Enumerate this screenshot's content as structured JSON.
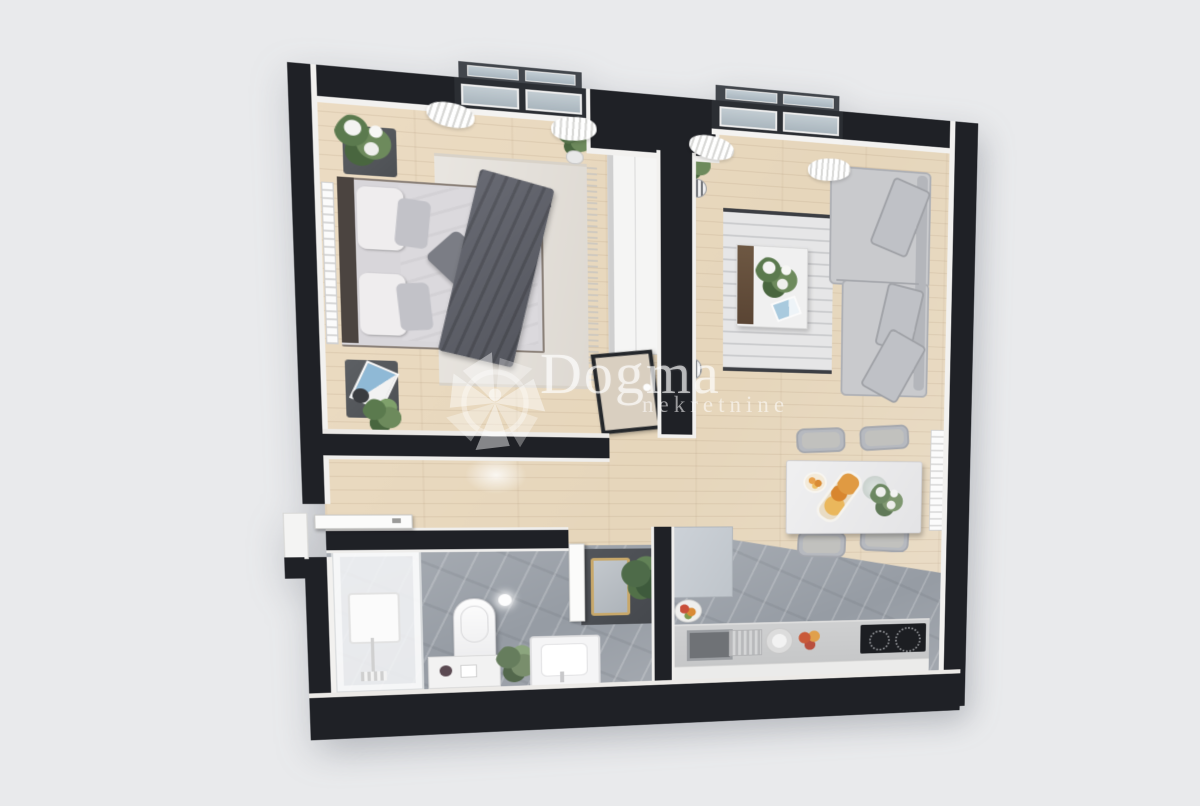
{
  "watermark": {
    "brand": "Dogma",
    "tagline": "nekretnine"
  },
  "palette": {
    "background": "#e9eaec",
    "wall": "#1f2126",
    "wall_inner_face": "#f2f1ef",
    "wood_floor": "#e8dac1",
    "tile_floor": "#9aa0a7",
    "window_glass": "#b9c6ce",
    "sofa": "#c7c8cc",
    "bed_blanket": "#5f616a",
    "counter": "#cbcccd",
    "hob": "#1c1e22",
    "watermark_white": "rgba(255,255,255,0.6)"
  },
  "scene": {
    "type": "3d-floor-plan-render",
    "rooms": [
      {
        "name": "bedroom",
        "furniture": [
          "double-bed",
          "headboard",
          "nightstand-top",
          "nightstand-bottom",
          "area-rug",
          "radiator",
          "wardrobe",
          "potted-plant",
          "door"
        ]
      },
      {
        "name": "living-room",
        "furniture": [
          "corner-sofa",
          "coffee-table",
          "area-rug",
          "wall-tv",
          "floor-plant",
          "striped-vases",
          "radiator"
        ]
      },
      {
        "name": "dining-area",
        "furniture": [
          "dining-table",
          "chair",
          "chair",
          "chair",
          "chair",
          "pastry-tray",
          "flower-vase"
        ]
      },
      {
        "name": "kitchen",
        "furniture": [
          "tall-cabinet",
          "counter",
          "sink",
          "dish-drainer",
          "plate",
          "fruits",
          "induction-hob",
          "fruit-bowl"
        ]
      },
      {
        "name": "bathroom",
        "furniture": [
          "shower-cabin",
          "toilet",
          "washbasin",
          "storage-cabinet",
          "vanity-console",
          "gold-mirror",
          "fern-plant",
          "ceiling-light",
          "towel-rail",
          "door"
        ]
      },
      {
        "name": "hallway",
        "furniture": [
          "entry-door"
        ]
      }
    ]
  }
}
